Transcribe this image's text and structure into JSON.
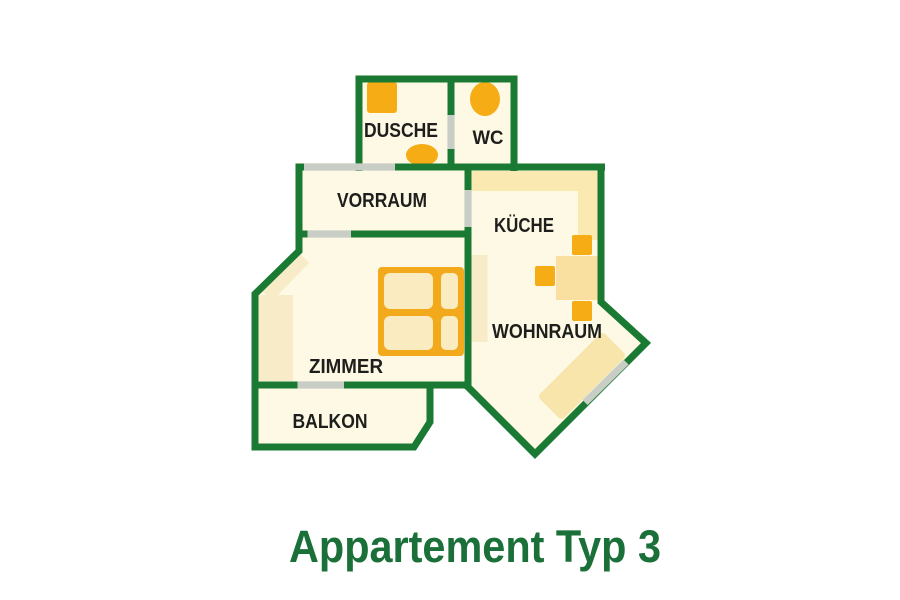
{
  "title": "Appartement Typ 3",
  "rooms": [
    {
      "name": "dusche",
      "label": "DUSCHE"
    },
    {
      "name": "wc",
      "label": "WC"
    },
    {
      "name": "vorraum",
      "label": "VORRAUM"
    },
    {
      "name": "kueche",
      "label": "KÜCHE"
    },
    {
      "name": "wohnraum",
      "label": "WOHNRAUM"
    },
    {
      "name": "zimmer",
      "label": "ZIMMER"
    },
    {
      "name": "balkon",
      "label": "BALKON"
    }
  ],
  "colors": {
    "wall_green": "#1a7a33",
    "floor_cream": "#fdf9e5",
    "counter_tan": "#fbe9b2",
    "furniture_tan": "#f8ecc8",
    "table_tan": "#f9dfa0",
    "couch_tan": "#f8e5ab",
    "bed_cell_cream": "#faecc0",
    "furniture_orange": "#f5ac15",
    "bed_orange": "#f2a91c",
    "door_gray": "#c8cec5",
    "label_color": "#1e1e1c",
    "title_green": "#1a7038",
    "background": "#ffffff"
  },
  "furniture_icons": [
    "shower-icon",
    "washbasin-icon",
    "toilet-icon",
    "kitchen-counter",
    "dining-table",
    "chair",
    "bed",
    "wardrobe",
    "cabinet",
    "couch"
  ]
}
